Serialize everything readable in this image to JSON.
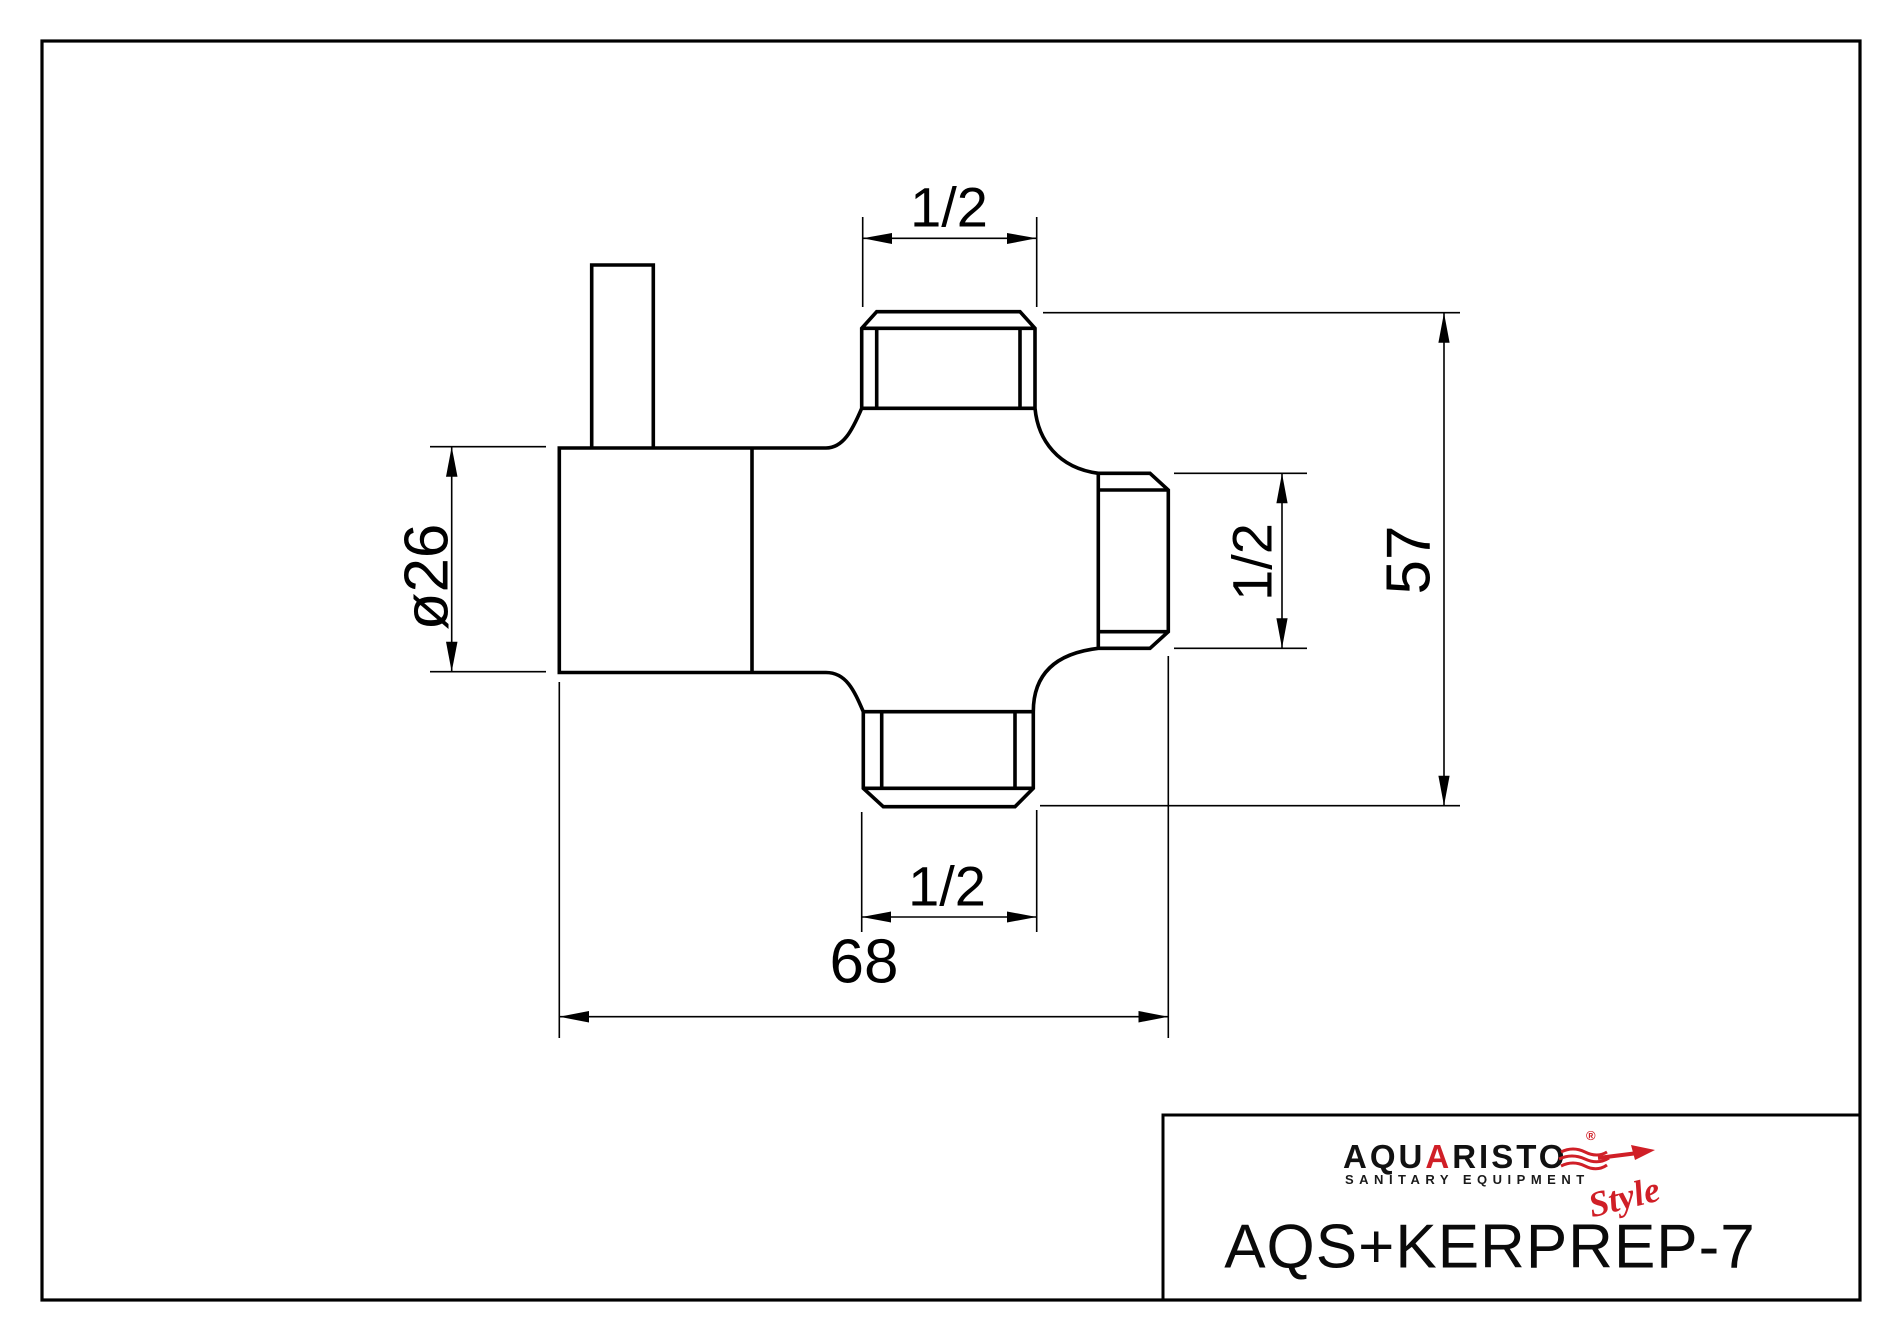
{
  "dimensions": {
    "top_port_width": "1/2",
    "right_port_height": "1/2",
    "total_height": "57",
    "flange_diameter": "ø26",
    "bottom_port_width": "1/2",
    "total_width": "68"
  },
  "title_block": {
    "part_number": "AQS+KERPREP-7",
    "logo": {
      "part1": "AQU",
      "part2": "A",
      "part3": "RIST",
      "part4": "O",
      "registered": "®",
      "subtitle": "SANITARY EQUIPMENT",
      "script": "Style"
    },
    "colors": {
      "logo_red": "#d01f27",
      "line_black": "#000000"
    }
  }
}
